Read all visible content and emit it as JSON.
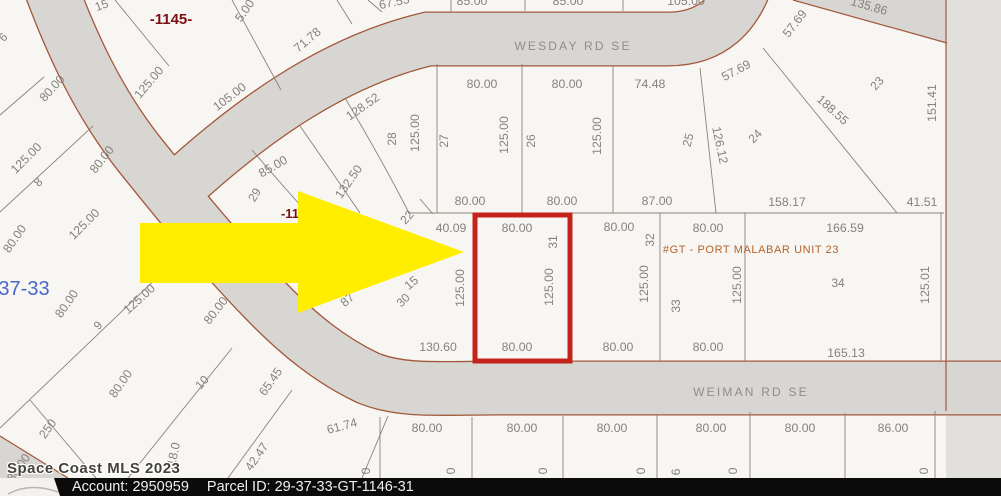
{
  "map": {
    "streets": [
      {
        "t": "WESDAY RD SE",
        "x": 573,
        "y": 50
      },
      {
        "t": "WEIMAN RD SE",
        "x": 751,
        "y": 396
      }
    ],
    "annotations": [
      {
        "t": "-1145-",
        "x": 171,
        "y": 24,
        "cls": "red-bold",
        "size": 15
      },
      {
        "t": "-11",
        "x": 290,
        "y": 218,
        "cls": "red-bold",
        "size": 13
      },
      {
        "t": "37-33",
        "x": 24,
        "y": 295,
        "cls": "blue-sec",
        "size": 20
      },
      {
        "t": "#GT - PORT MALABAR UNIT 23",
        "x": 751,
        "y": 253,
        "cls": "unit",
        "size": 11
      }
    ],
    "dims": [
      {
        "t": "5.00",
        "x": 248,
        "y": 13,
        "r": -55
      },
      {
        "t": "125.00",
        "x": 152,
        "y": 85,
        "r": -50
      },
      {
        "t": "105.00",
        "x": 232,
        "y": 100,
        "r": -37
      },
      {
        "t": "71.78",
        "x": 310,
        "y": 43,
        "r": -40
      },
      {
        "t": "67.53",
        "x": 395,
        "y": 6,
        "r": -12
      },
      {
        "t": "85.00",
        "x": 472,
        "y": 5,
        "r": 0
      },
      {
        "t": "85.00",
        "x": 568,
        "y": 5,
        "r": 0
      },
      {
        "t": "105.00",
        "x": 686,
        "y": 5,
        "r": 0
      },
      {
        "t": "80.00",
        "x": 482,
        "y": 88,
        "r": 0
      },
      {
        "t": "80.00",
        "x": 567,
        "y": 88,
        "r": 0
      },
      {
        "t": "74.48",
        "x": 650,
        "y": 88,
        "r": 0
      },
      {
        "t": "57.69",
        "x": 798,
        "y": 26,
        "r": -52
      },
      {
        "t": "57.69",
        "x": 738,
        "y": 74,
        "r": -28
      },
      {
        "t": "135.86",
        "x": 868,
        "y": 10,
        "r": 16
      },
      {
        "t": "151.41",
        "x": 936,
        "y": 103,
        "r": -90
      },
      {
        "t": "188.55",
        "x": 830,
        "y": 113,
        "r": 42
      },
      {
        "t": "126.12",
        "x": 716,
        "y": 146,
        "r": 78
      },
      {
        "t": "128.52",
        "x": 365,
        "y": 110,
        "r": -35
      },
      {
        "t": "125.00",
        "x": 419,
        "y": 133,
        "r": -90
      },
      {
        "t": "125.00",
        "x": 508,
        "y": 135,
        "r": -90
      },
      {
        "t": "125.00",
        "x": 601,
        "y": 136,
        "r": -90
      },
      {
        "t": "80.00",
        "x": 470,
        "y": 205,
        "r": 0
      },
      {
        "t": "80.00",
        "x": 562,
        "y": 205,
        "r": 0
      },
      {
        "t": "87.00",
        "x": 657,
        "y": 205,
        "r": 0
      },
      {
        "t": "158.17",
        "x": 787,
        "y": 206,
        "r": 0
      },
      {
        "t": "41.51",
        "x": 922,
        "y": 206,
        "r": 0
      },
      {
        "t": "132.50",
        "x": 352,
        "y": 184,
        "r": -55
      },
      {
        "t": "85.00",
        "x": 275,
        "y": 170,
        "r": -30
      },
      {
        "t": "40.09",
        "x": 451,
        "y": 232,
        "r": 0
      },
      {
        "t": "80.00",
        "x": 517,
        "y": 232,
        "r": 0
      },
      {
        "t": "80.00",
        "x": 619,
        "y": 231,
        "r": 0
      },
      {
        "t": "80.00",
        "x": 708,
        "y": 232,
        "r": 0
      },
      {
        "t": "166.59",
        "x": 845,
        "y": 232,
        "r": 0
      },
      {
        "t": "125.00",
        "x": 464,
        "y": 288,
        "r": -90
      },
      {
        "t": "125.00",
        "x": 553,
        "y": 287,
        "r": -90
      },
      {
        "t": "125.00",
        "x": 648,
        "y": 284,
        "r": -90
      },
      {
        "t": "125.00",
        "x": 741,
        "y": 285,
        "r": -90
      },
      {
        "t": "125.01",
        "x": 929,
        "y": 285,
        "r": -90
      },
      {
        "t": "80.00",
        "x": 517,
        "y": 351,
        "r": 0
      },
      {
        "t": "130.60",
        "x": 438,
        "y": 351,
        "r": 0
      },
      {
        "t": "80.00",
        "x": 618,
        "y": 351,
        "r": 0
      },
      {
        "t": "80.00",
        "x": 708,
        "y": 351,
        "r": 0
      },
      {
        "t": "165.13",
        "x": 846,
        "y": 357,
        "r": 0
      },
      {
        "t": "87",
        "x": 350,
        "y": 303,
        "r": -40
      },
      {
        "t": "15",
        "x": 414,
        "y": 286,
        "r": -40
      },
      {
        "t": "80.00",
        "x": 55,
        "y": 91,
        "r": -48
      },
      {
        "t": "125.00",
        "x": 29,
        "y": 161,
        "r": -45
      },
      {
        "t": "80.00",
        "x": 105,
        "y": 162,
        "r": -52
      },
      {
        "t": "125.00",
        "x": 87,
        "y": 227,
        "r": -45
      },
      {
        "t": "80.00",
        "x": 18,
        "y": 241,
        "r": -55
      },
      {
        "t": "80.00",
        "x": 70,
        "y": 306,
        "r": -55
      },
      {
        "t": "125.00",
        "x": 142,
        "y": 302,
        "r": -42
      },
      {
        "t": "80.00",
        "x": 219,
        "y": 313,
        "r": -52
      },
      {
        "t": "80.00",
        "x": 124,
        "y": 386,
        "r": -55
      },
      {
        "t": "250",
        "x": 51,
        "y": 431,
        "r": -55
      },
      {
        "t": "80.00",
        "x": 22,
        "y": 470,
        "r": -55
      },
      {
        "t": "118.0",
        "x": 177,
        "y": 458,
        "r": -78
      },
      {
        "t": "42.47",
        "x": 260,
        "y": 459,
        "r": -55
      },
      {
        "t": "65.45",
        "x": 274,
        "y": 384,
        "r": -55
      },
      {
        "t": "61.74",
        "x": 343,
        "y": 430,
        "r": -15
      },
      {
        "t": "80.00",
        "x": 427,
        "y": 432,
        "r": 0
      },
      {
        "t": "80.00",
        "x": 522,
        "y": 432,
        "r": 0
      },
      {
        "t": "80.00",
        "x": 612,
        "y": 432,
        "r": 0
      },
      {
        "t": "80.00",
        "x": 711,
        "y": 432,
        "r": 0
      },
      {
        "t": "80.00",
        "x": 800,
        "y": 432,
        "r": 0
      },
      {
        "t": "86.00",
        "x": 893,
        "y": 432,
        "r": 0
      },
      {
        "t": "0",
        "x": 370,
        "y": 471,
        "r": -90
      },
      {
        "t": "0",
        "x": 455,
        "y": 471,
        "r": -90
      },
      {
        "t": "0",
        "x": 547,
        "y": 471,
        "r": -90
      },
      {
        "t": "0",
        "x": 645,
        "y": 471,
        "r": -90
      },
      {
        "t": "6",
        "x": 680,
        "y": 472,
        "r": -90
      },
      {
        "t": "0",
        "x": 737,
        "y": 471,
        "r": -90
      },
      {
        "t": "0",
        "x": 928,
        "y": 471,
        "r": -90
      }
    ],
    "lots": [
      {
        "t": "15",
        "x": 103,
        "y": 9,
        "r": -20
      },
      {
        "t": "6",
        "x": 6,
        "y": 40,
        "r": -45
      },
      {
        "t": "8",
        "x": 41,
        "y": 185,
        "r": -45
      },
      {
        "t": "9",
        "x": 101,
        "y": 328,
        "r": -48
      },
      {
        "t": "10",
        "x": 205,
        "y": 385,
        "r": -48
      },
      {
        "t": "28",
        "x": 396,
        "y": 139,
        "r": -90
      },
      {
        "t": "27",
        "x": 448,
        "y": 141,
        "r": -90
      },
      {
        "t": "26",
        "x": 535,
        "y": 141,
        "r": -90
      },
      {
        "t": "25",
        "x": 692,
        "y": 141,
        "r": -75
      },
      {
        "t": "24",
        "x": 758,
        "y": 139,
        "r": -45
      },
      {
        "t": "23",
        "x": 880,
        "y": 86,
        "r": -48
      },
      {
        "t": "29",
        "x": 258,
        "y": 197,
        "r": -58
      },
      {
        "t": "22",
        "x": 410,
        "y": 220,
        "r": -48
      },
      {
        "t": "30",
        "x": 406,
        "y": 303,
        "r": -45
      },
      {
        "t": "31",
        "x": 557,
        "y": 242,
        "r": -90
      },
      {
        "t": "32",
        "x": 654,
        "y": 240,
        "r": -90
      },
      {
        "t": "33",
        "x": 680,
        "y": 306,
        "r": -90
      },
      {
        "t": "34",
        "x": 838,
        "y": 287,
        "r": 0
      }
    ]
  },
  "colors": {
    "arrow_fill": "#ffee00",
    "highlight_stroke": "#c3231a",
    "road_fill": "#d8d6d3",
    "road_edge": "#a2583a",
    "lot_line": "#8d8178",
    "outside_fill": "#e2e0dd"
  },
  "watermark": "Space Coast MLS 2023",
  "footer": {
    "account_label": "Account:",
    "account_value": "2950959",
    "parcel_label": "Parcel ID:",
    "parcel_value": "29-37-33-GT-1146-31"
  }
}
